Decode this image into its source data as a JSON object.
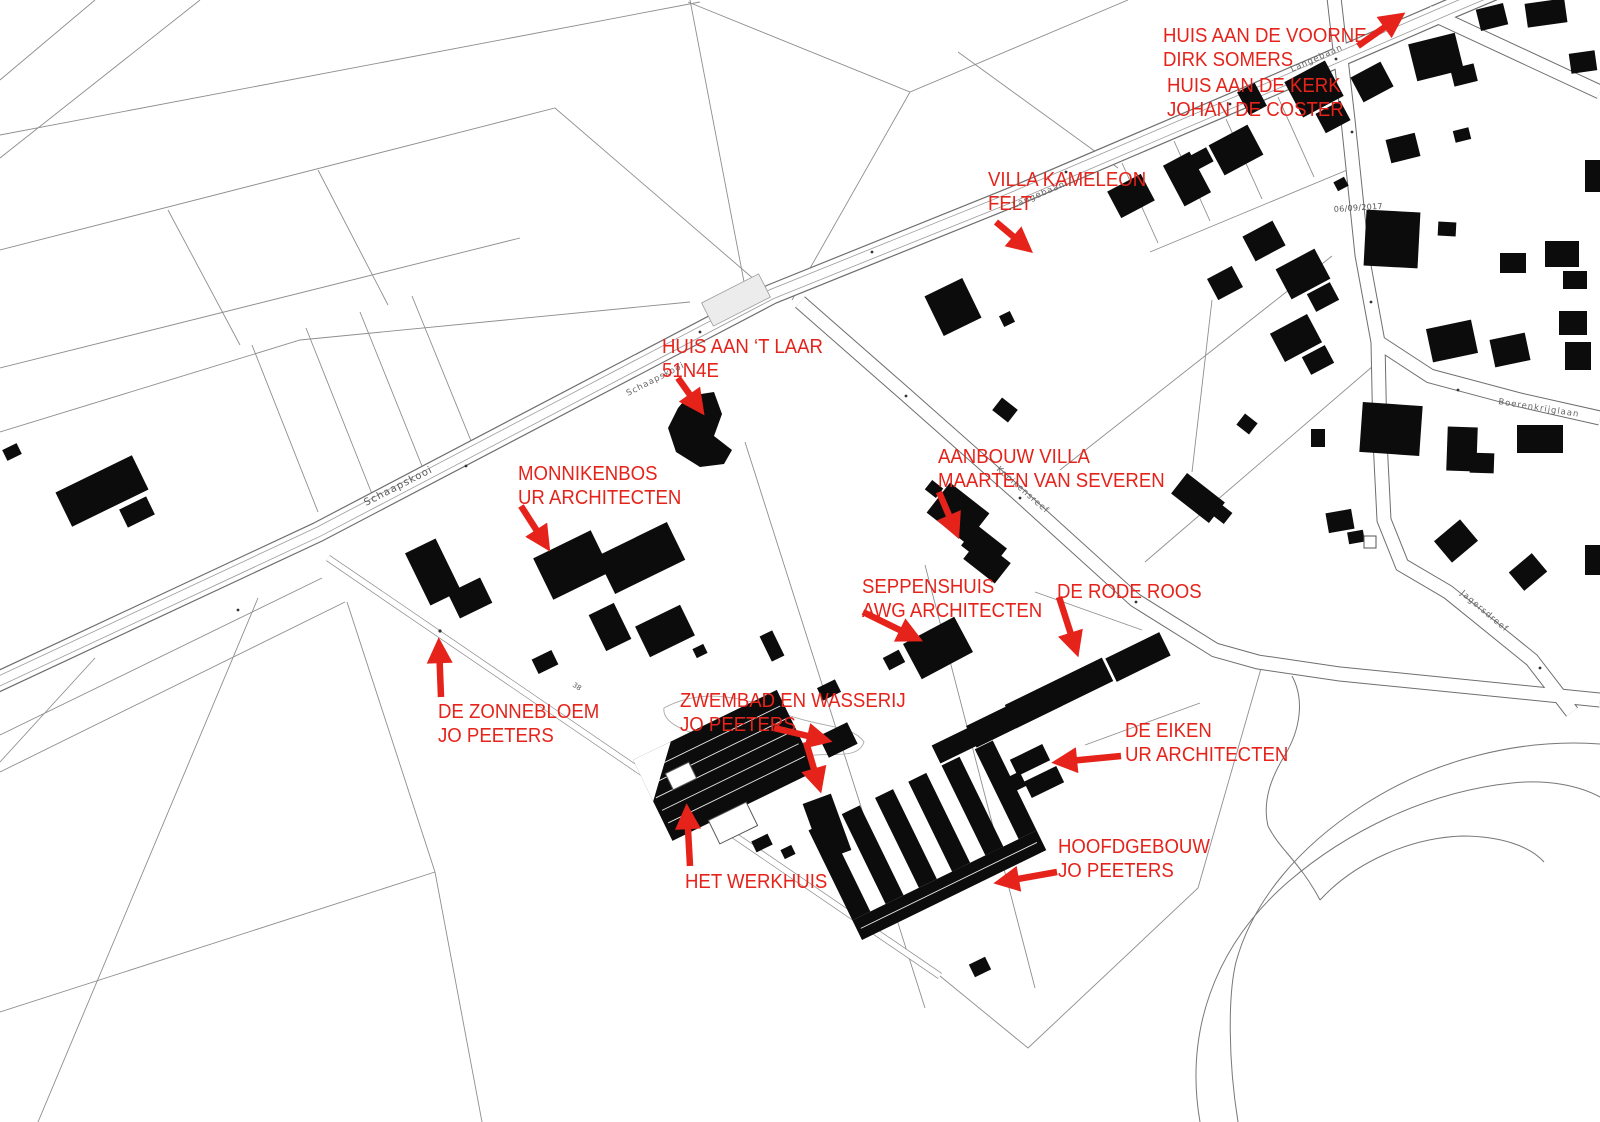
{
  "colors": {
    "background": "#ffffff",
    "parcel_line": "#8e8e8e",
    "road_edge": "#6e6e6e",
    "building": "#0c0c0c",
    "annotation": "#e5231b",
    "street_label": "#5a5a5a"
  },
  "street_labels": [
    {
      "text": "Schaapskooi"
    },
    {
      "text": "Schaapskooi"
    },
    {
      "text": "Langebaan"
    },
    {
      "text": "Langebaan"
    },
    {
      "text": "Konikensreef"
    },
    {
      "text": "Boerenkrijglaan"
    },
    {
      "text": "Jagersdreef"
    },
    {
      "text": "06/09/2017"
    },
    {
      "text": "38"
    }
  ],
  "annotations": [
    {
      "name": "huis-aan-de-voorne",
      "lines": [
        "HUIS AAN DE VOORNE",
        "DIRK SOMERS"
      ]
    },
    {
      "name": "huis-aan-de-kerk",
      "lines": [
        "HUIS AAN DE KERK",
        "JOHAN DE COSTER"
      ]
    },
    {
      "name": "villa-kameleon",
      "lines": [
        "VILLA KAMELEON",
        "FELT"
      ]
    },
    {
      "name": "huis-aan-t-laar",
      "lines": [
        "HUIS AAN ‘T LAAR",
        "51N4E"
      ]
    },
    {
      "name": "monnikenbos",
      "lines": [
        "MONNIKENBOS",
        "UR ARCHITECTEN"
      ]
    },
    {
      "name": "aanbouw-villa",
      "lines": [
        "AANBOUW VILLA",
        "MAARTEN VAN SEVEREN"
      ]
    },
    {
      "name": "seppenshuis",
      "lines": [
        "SEPPENSHUIS",
        "AWG ARCHITECTEN"
      ]
    },
    {
      "name": "de-rode-roos",
      "lines": [
        "DE RODE ROOS"
      ]
    },
    {
      "name": "de-zonnebloem",
      "lines": [
        "DE ZONNEBLOEM",
        "JO PEETERS"
      ]
    },
    {
      "name": "zwembad-en-wasserij",
      "lines": [
        "ZWEMBAD EN WASSERIJ",
        "JO PEETERS"
      ]
    },
    {
      "name": "de-eiken",
      "lines": [
        "DE EIKEN",
        "UR ARCHITECTEN"
      ]
    },
    {
      "name": "het-werkhuis",
      "lines": [
        "HET WERKHUIS"
      ]
    },
    {
      "name": "hoofdgebouw",
      "lines": [
        "HOOFDGEBOUW",
        "JO PEETERS"
      ]
    }
  ]
}
